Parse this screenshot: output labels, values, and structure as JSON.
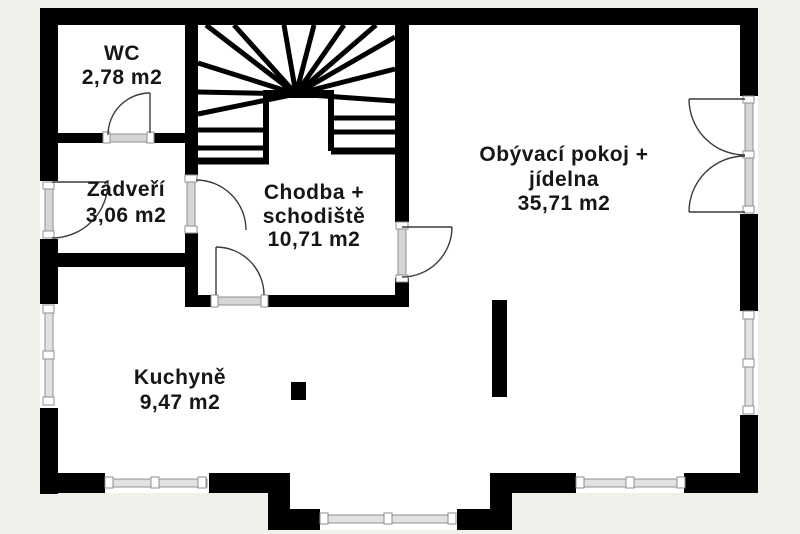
{
  "title": "Floor plan",
  "theme": {
    "background": "#f0efea",
    "floor": "#ffffff",
    "wall": "#000000",
    "glass_fill": "#e2e2e2",
    "glass_stroke": "#8f8f8f",
    "door_strip": "#d6d6d6",
    "swing_stroke": "#3c3c3c",
    "text_color": "#161616"
  },
  "rooms": [
    {
      "id": "wc",
      "name": "WC",
      "area": "2,78 m2",
      "lines": [
        "WC",
        "2,78 m2"
      ]
    },
    {
      "id": "zadveri",
      "name": "Zádveří",
      "area": "3,06 m2",
      "lines": [
        "Zádveří",
        "3,06 m2"
      ]
    },
    {
      "id": "chodba",
      "name": "Chodba + schodiště",
      "area": "10,71 m2",
      "lines": [
        "Chodba +",
        "schodiště",
        "10,71 m2"
      ]
    },
    {
      "id": "obyvaci",
      "name": "Obývací pokoj + jídelna",
      "area": "35,71 m2",
      "lines": [
        "Obývací pokoj +",
        "jídelna",
        "35,71 m2"
      ]
    },
    {
      "id": "kuchyne",
      "name": "Kuchyně",
      "area": "9,47 m2",
      "lines": [
        "Kuchyně",
        "9,47 m2"
      ]
    }
  ]
}
